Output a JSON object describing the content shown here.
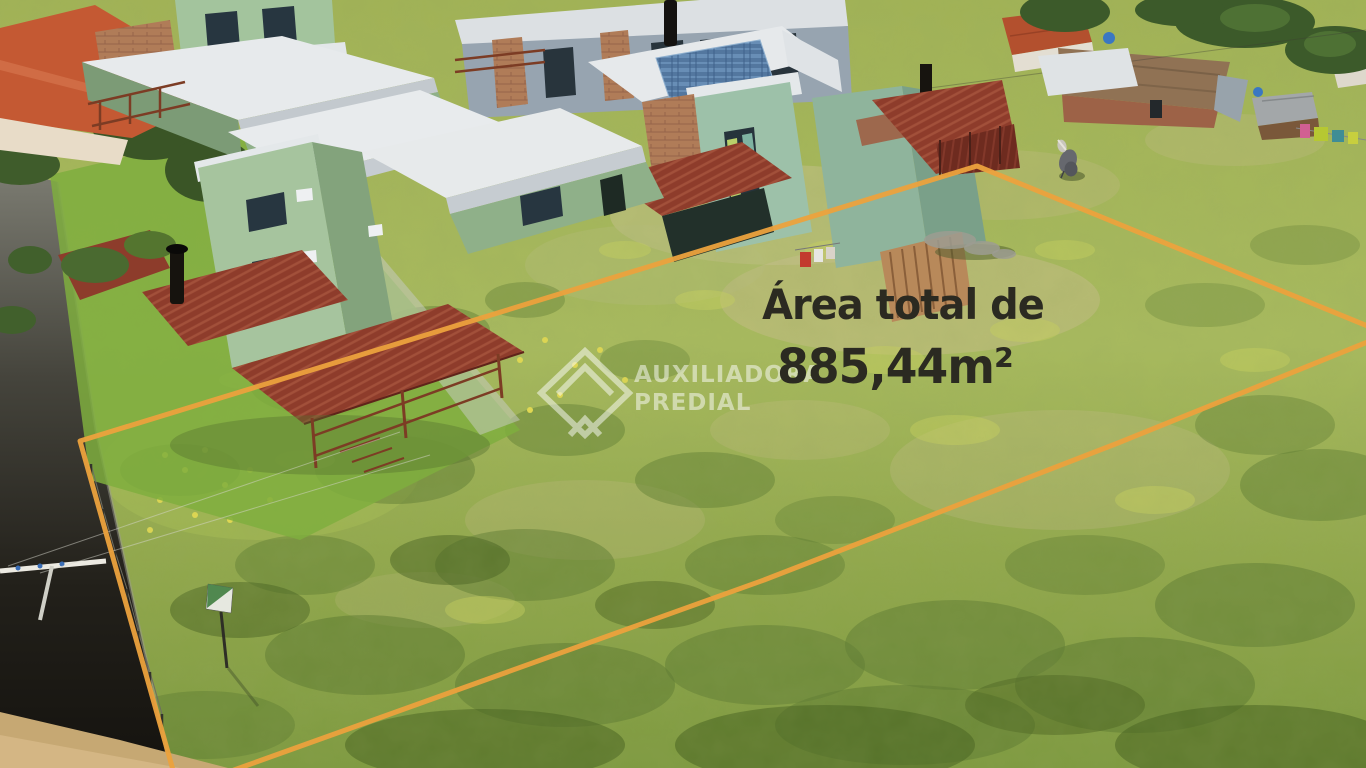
{
  "photo": {
    "kind": "aerial-drone-photo",
    "subject": "Vacant residential land plot for sale with highlighted boundary",
    "overlay_text": {
      "line1": "Área total de",
      "line2": "885,44m²"
    },
    "watermark": {
      "line1": "AUXILIADORA",
      "line2": "PREDIAL",
      "logo": "house-diamond-outline"
    },
    "colors": {
      "boundary_orange": "#ECA23D",
      "overlay_text": "#2B2A21",
      "watermark_white": "#FFFFFF",
      "grass_light": "#A8BA5E",
      "grass_dark": "#5C7A31",
      "roof_slab_white": "#E7EAEC",
      "house_green": "#A6C49E",
      "pergola_red": "#8E3C2B",
      "brick": "#B07C58",
      "road_shadow": "#1F1D17",
      "sand": "#C6A873"
    },
    "boundary_corners_px": [
      [
        80,
        441
      ],
      [
        977,
        166
      ],
      [
        1370,
        330
      ],
      [
        233,
        770
      ]
    ],
    "scene_objects": [
      "row-of-green-duplex-houses",
      "white-flat-roof-slabs",
      "red-corrugated-pergola-roofs",
      "brick-accent-columns",
      "wood-balconies-and-stairs",
      "black-chimney-flues",
      "air-conditioner-units",
      "blue-solar-panel-roof",
      "neighbor-house-red-tile-roof",
      "old-brick-house-rusty-roof",
      "wooden-shed",
      "clothesline-with-colorful-clothes",
      "blue-water-tanks",
      "grey-horse",
      "grass-field-with-shrubs",
      "sandy-patches",
      "dense-bushes-foreground",
      "shaded-dirt-road",
      "utility-pole-with-wires",
      "fence-posts-along-street",
      "small-sale-sign",
      "trees"
    ]
  }
}
